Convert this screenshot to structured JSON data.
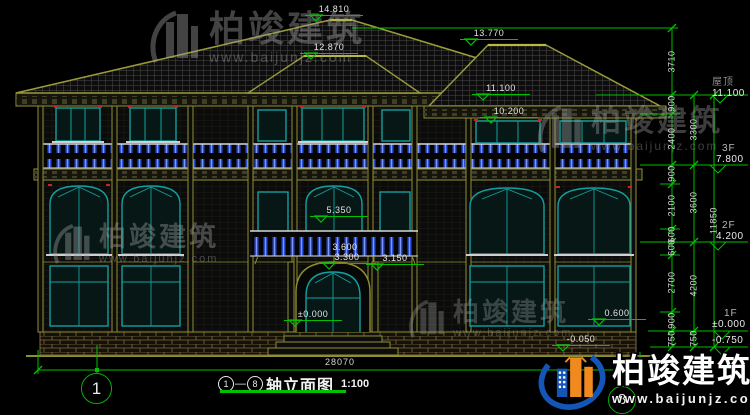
{
  "title_block": {
    "axis_start": "1",
    "dash": "—",
    "axis_end": "8",
    "name": "轴立面图",
    "scale": "1:100"
  },
  "watermark": {
    "brand": "柏竣建筑",
    "url": "www.baijunjz.com"
  },
  "axis_bubbles": {
    "left": "1",
    "right": "8"
  },
  "bottom_dim": {
    "total_width": "28070"
  },
  "right_dims": {
    "col1": [
      "3710",
      "900",
      "2400",
      "900",
      "2100",
      "600",
      "600",
      "2700",
      "900",
      "750"
    ],
    "col2": [
      "3300",
      "3600",
      "4200",
      "750"
    ],
    "col3": [
      "11850"
    ]
  },
  "floor_flags": [
    {
      "label": "屋顶",
      "value": "11.100"
    },
    {
      "label": "3F",
      "value": "7.800"
    },
    {
      "label": "2F",
      "value": "4.200"
    },
    {
      "label": "1F",
      "value": "±0.000"
    },
    {
      "label": "",
      "value": "-0.750"
    }
  ],
  "elevation_markers": [
    {
      "value": "14.810"
    },
    {
      "value": "12.870"
    },
    {
      "value": "13.770"
    },
    {
      "value": "11.100"
    },
    {
      "value": "10.200"
    },
    {
      "value": "5.350"
    },
    {
      "value": "3.600"
    },
    {
      "value": "3.300"
    },
    {
      "value": "3.150"
    },
    {
      "value": "±0.000"
    },
    {
      "value": "0.600"
    },
    {
      "value": "-0.050"
    }
  ],
  "colors": {
    "background": "#000000",
    "linework_olive": "#8f8f2f",
    "dimension_green": "#00c000",
    "window_teal": "#12a0a0",
    "baluster_blue": "#2b4fd0",
    "text_white": "#e8e8e8",
    "watermark_gray": "#a0a0a0",
    "brand_blue": "#1456b8",
    "brand_orange": "#f08a1e",
    "accent_red": "#cc2222"
  }
}
